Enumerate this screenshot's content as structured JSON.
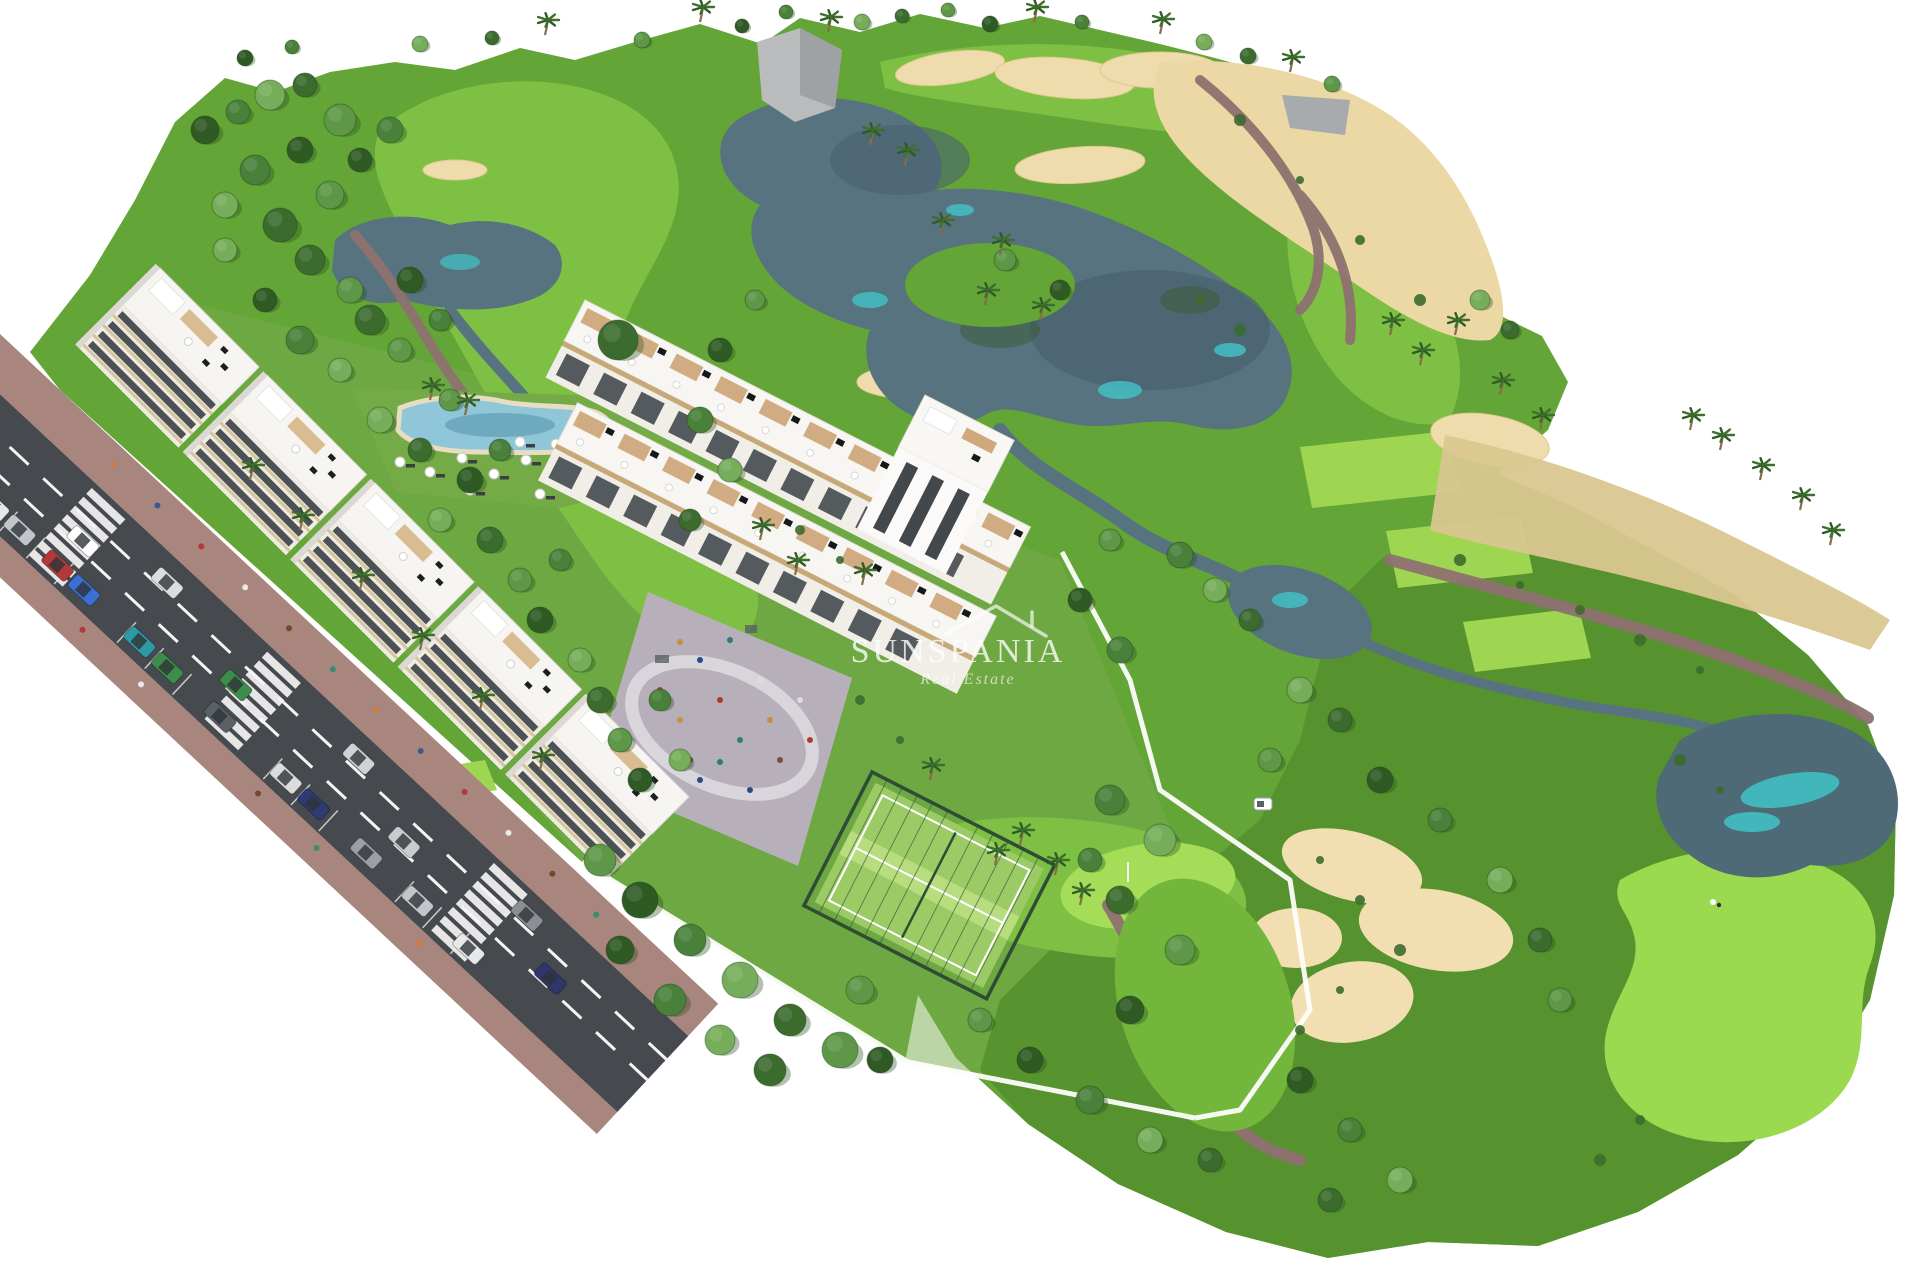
{
  "watermark": {
    "brand": "SUNSPANIA",
    "tagline": "Real Estate",
    "icon": "house-roof-icon"
  },
  "colors": {
    "grass": "#63a536",
    "rough_dark": "#54902d",
    "fairway": "#7dc044",
    "green_light": "#a6dd58",
    "tee_light": "#9ed651",
    "water": "#56737f",
    "water_highlight": "#41c4c8",
    "sand": "#eedcad",
    "scrub": "#d9c78f",
    "path": "#8e7170",
    "road_asphalt": "#46494e",
    "sidewalk": "#a8867e",
    "building_white": "#f6f5f1",
    "facade_band": "#d7c49c",
    "window_dark": "#363b42",
    "pool_water": "#8fc6d8",
    "pergola_tan": "#cfa87b",
    "court_green": "#9ccb66",
    "playground_paving": "#b7b0ba",
    "wall_white": "#fdfdfb"
  }
}
